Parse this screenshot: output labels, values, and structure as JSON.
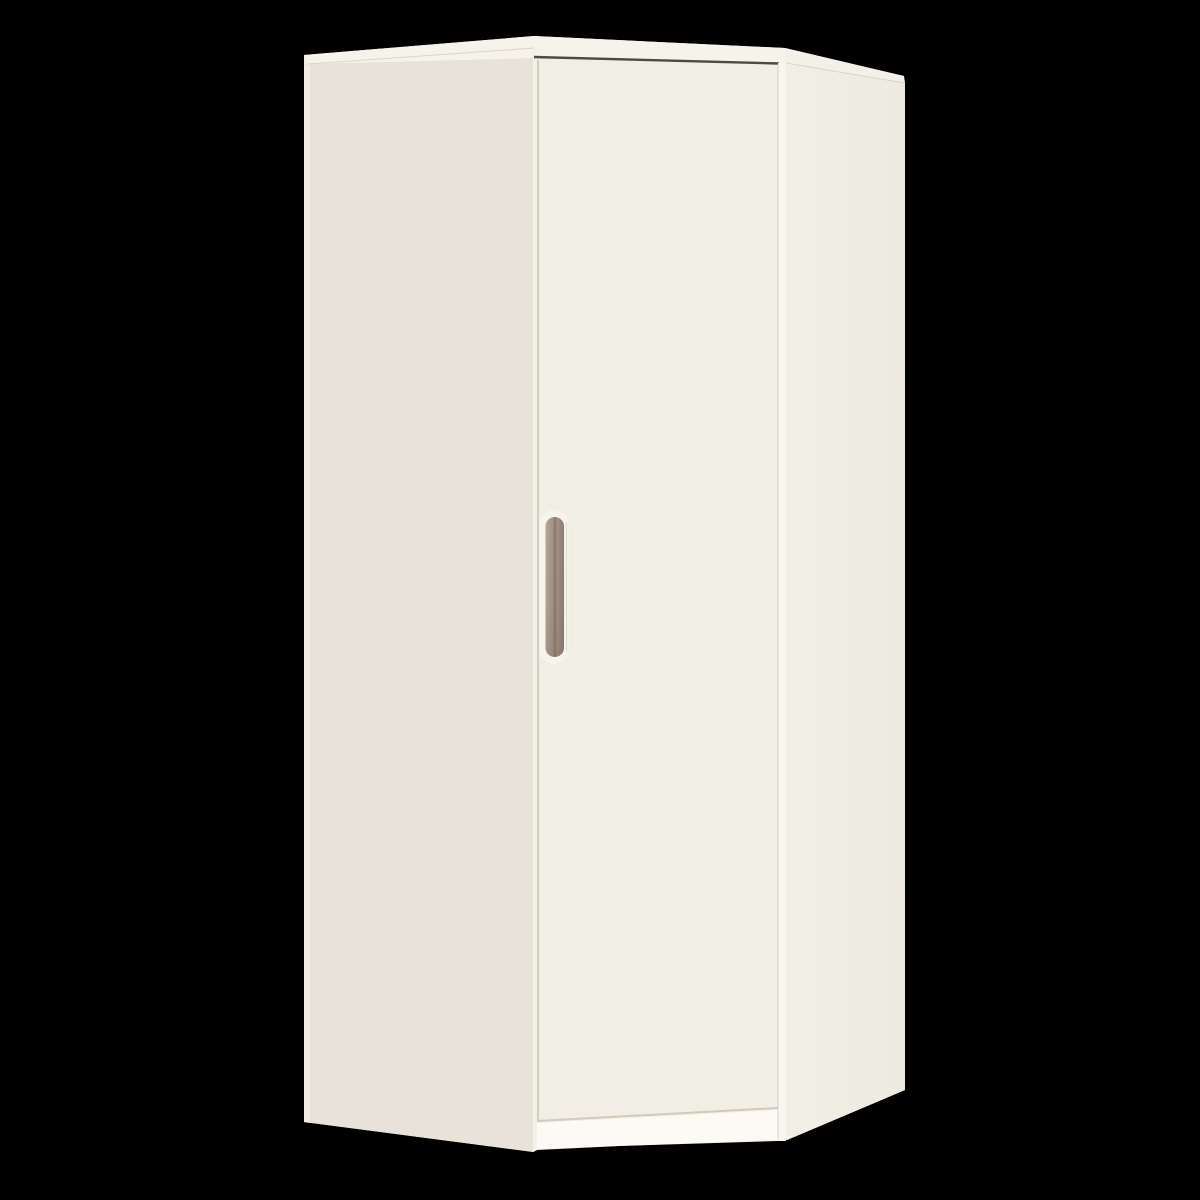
{
  "scene": {
    "description": "Product render of a cream corner wardrobe with a single door, taupe recessed vertical handle, and white plinth, centered on a black background",
    "background_color": "#000000"
  },
  "wardrobe": {
    "parts": {
      "left_side_panel": "angled left side panel",
      "door": "front door panel",
      "handle": "vertical recessed pill handle",
      "right_side_panel": "right side panel",
      "top_panel": "top panel edge",
      "plinth": "recessed white plinth under door"
    },
    "colors": {
      "background": "#000000",
      "left_panel": "#e7e3d9",
      "left_edge_highlight": "#efece3",
      "door_face": "#f1eee4",
      "door_left_bright_strip": "#f4f1e8",
      "seam_beige": "#ccc5b5",
      "door_bottom_seam": "#d2cbbb",
      "top_sliver": "#f6f3ea",
      "right_top_band": "#f3f0e7",
      "right_edge_strip": "#f8f6ef",
      "right_panel_near": "#f2efe6",
      "right_panel_far": "#edeae1",
      "plinth": "#fcfaf5",
      "door_top_gap_dark": "#4e4943",
      "crease_line": "#d9d5ca",
      "handle_light": "#b6a79b",
      "handle_mid": "#a29186",
      "handle_dark": "#8c7b70",
      "handle_ridge": "#857366",
      "handle_shade": "#786454",
      "handle_recess": "#f6f4ed",
      "recess_shadow": "#ded8cc"
    }
  }
}
